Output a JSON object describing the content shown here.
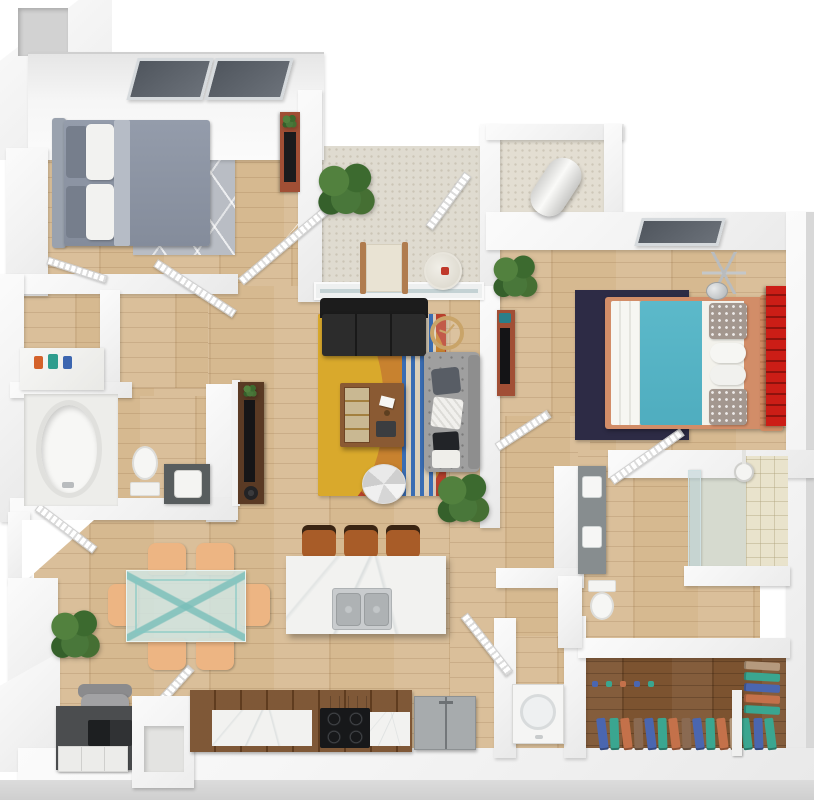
{
  "meta": {
    "title": "3D top-down floor plan render of a two-bedroom, two-bathroom apartment",
    "view": "top-down 3D architectural rendering",
    "visible_text": "none"
  },
  "palette": {
    "background": "#ffffff",
    "wall": "#f2f2f2",
    "wall_shadow": "#d8d8d8",
    "floor_wood": "#d6b990",
    "floor_wood_dark": "#7c5330",
    "floor_patio": "#dfdbd0",
    "window_glass": "#5a6068",
    "rug_gray": "#b9bdc4",
    "rug_navy": "#2d2b45",
    "rug_red": "#b8402c",
    "rug_orange": "#c8822f",
    "rug_yellow": "#d9a92c",
    "rug_blue_stripe": "#3a6db3",
    "sofa_black": "#262626",
    "loveseat_gray": "#a0a0a0",
    "bed_gray": "#8b93a3",
    "bed_teal": "#55b4c6",
    "bed_frame_tan": "#d28d68",
    "accent_red": "#cc1d16",
    "stool_brown": "#a85c28",
    "chair_peach": "#edb583",
    "plant_green": "#3f6b35",
    "marble": "#f2f2f0",
    "appliance_gray": "#a7abad",
    "clothes_colors": [
      "#4a66b0",
      "#3aa690",
      "#c4714a",
      "#8a6a52",
      "#b59a7e"
    ]
  },
  "rooms": [
    {
      "name": "Bedroom 2",
      "furniture": [
        "queen bed with gray duvet and white pillows",
        "gray patterned area rug",
        "dresser with TV and plant",
        "two dark roof windows"
      ]
    },
    {
      "name": "Patio / Balcony",
      "furniture": [
        "potted plant",
        "lounge chair",
        "round side table"
      ]
    },
    {
      "name": "Utility Closet",
      "furniture": [
        "water heater"
      ]
    },
    {
      "name": "Master Bedroom",
      "furniture": [
        "queen bed with teal duvet",
        "navy area rug",
        "red slatted wall art",
        "tripod floor lamp",
        "media dresser with TV",
        "potted plant",
        "dark roof window"
      ]
    },
    {
      "name": "Living Room",
      "furniture": [
        "black fabric sofa",
        "gray tufted loveseat with pillows and throw",
        "wood coffee table with shelf unit",
        "round segmented ottoman",
        "multicolor oval-pattern rug",
        "gold wall clock",
        "potted plant",
        "TV console with TV",
        "sliding glass door to patio"
      ]
    },
    {
      "name": "Bathroom 2",
      "furniture": [
        "oval bathtub on platform",
        "toilet",
        "vanity sink cabinet",
        "toiletry counter with colorful bottles",
        "linen closet"
      ]
    },
    {
      "name": "Dining Area",
      "furniture": [
        "glass dining table",
        "six peach upholstered chairs",
        "potted plant"
      ]
    },
    {
      "name": "Kitchen",
      "furniture": [
        "marble island with double stainless sink",
        "three brown bar stools",
        "black cooktop with range hood",
        "gray refrigerator",
        "dark wood counter run with marble tops"
      ]
    },
    {
      "name": "Desk Nook",
      "furniture": [
        "dark desk with laptop",
        "gray office chair",
        "white storage organizer",
        "pass-through counter"
      ]
    },
    {
      "name": "Hallway",
      "furniture": []
    },
    {
      "name": "Master Bathroom",
      "furniture": [
        "double sink vanity",
        "toilet",
        "glass shower with tile surround and shower head"
      ]
    },
    {
      "name": "Laundry Closet",
      "furniture": [
        "washer"
      ]
    },
    {
      "name": "Walk-in Closet",
      "furniture": [
        "hanging clothes in blue, teal, orange and brown",
        "side hanging rack"
      ]
    }
  ]
}
